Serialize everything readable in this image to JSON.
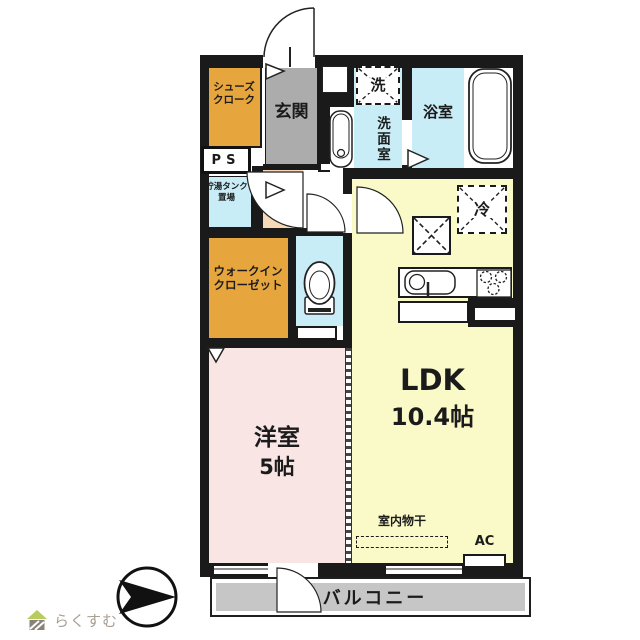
{
  "plan": {
    "rooms": {
      "shoes_closet": {
        "line1": "シューズ",
        "line2": "クローク"
      },
      "entrance": {
        "label": "玄関"
      },
      "pipe_space": {
        "label": "PS"
      },
      "water_tank": {
        "line1": "貯湯タンク",
        "line2": "置場"
      },
      "washer": {
        "label": "洗"
      },
      "washroom": {
        "label": "洗面室"
      },
      "bathroom": {
        "label": "浴室"
      },
      "fridge": {
        "label": "冷"
      },
      "walk_in_closet": {
        "line1": "ウォークイン",
        "line2": "クローゼット"
      },
      "western_room": {
        "name": "洋室",
        "size": "5帖"
      },
      "ldk": {
        "name": "LDK",
        "size": "10.4帖"
      },
      "indoor_drying": {
        "label": "室内物干"
      },
      "air_conditioner": {
        "label": "AC"
      },
      "balcony": {
        "label": "バルコニー"
      }
    },
    "colors": {
      "wall": "#1a1a1a",
      "closet_orange": "#e6a53d",
      "entrance_gray": "#acacac",
      "water_blue": "#c9edf6",
      "ldk_yellow": "#fafac9",
      "room_pink": "#fae5e5",
      "hall_peach": "#f7d9b8",
      "balcony_gray": "#c6c6c6",
      "logo_green": "#b8cc5e"
    }
  },
  "footer": {
    "logo_text": "らくすむ"
  }
}
